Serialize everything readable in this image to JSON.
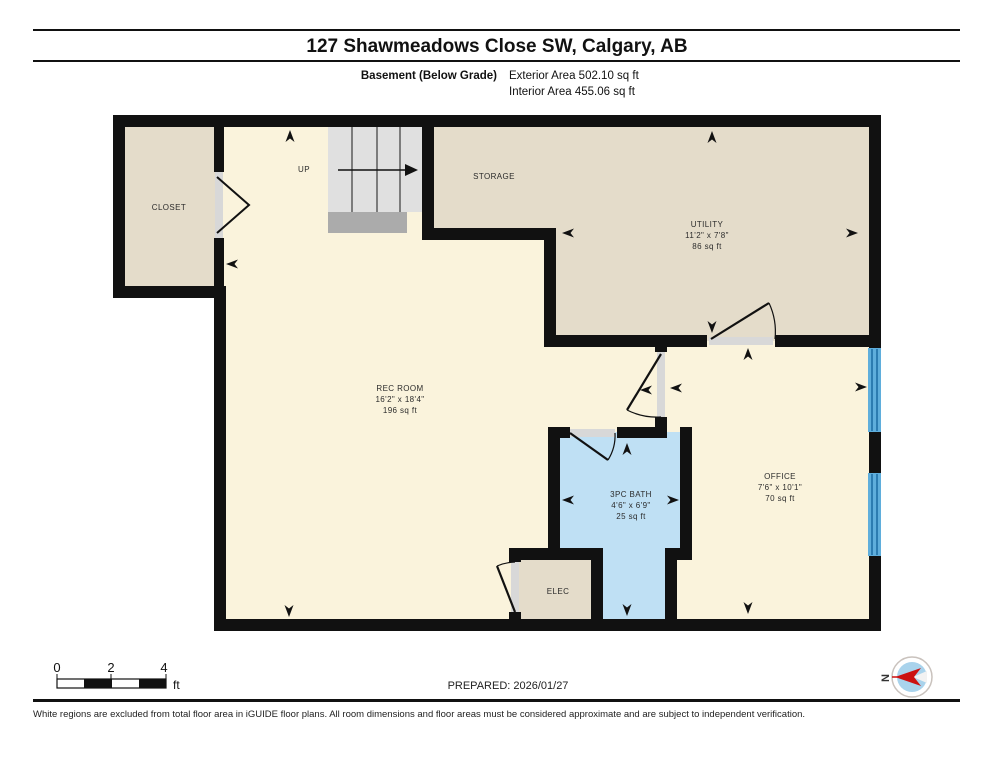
{
  "header": {
    "title": "127 Shawmeadows Close SW, Calgary, AB",
    "floor_label": "Basement (Below Grade)",
    "exterior_area": "Exterior Area 502.10 sq ft",
    "interior_area": "Interior Area 455.06 sq ft"
  },
  "rooms": {
    "closet": {
      "label": "CLOSET"
    },
    "stairs": {
      "label": "UP"
    },
    "storage": {
      "label": "STORAGE"
    },
    "utility": {
      "label": "UTILITY",
      "dimensions": "11'2\" x 7'8\"",
      "area": "86 sq ft"
    },
    "rec_room": {
      "label": "REC ROOM",
      "dimensions": "16'2\" x 18'4\"",
      "area": "196 sq ft"
    },
    "bath": {
      "label": "3PC BATH",
      "dimensions": "4'6\" x 6'9\"",
      "area": "25 sq ft"
    },
    "office": {
      "label": "OFFICE",
      "dimensions": "7'6\" x 10'1\"",
      "area": "70 sq ft"
    },
    "elec": {
      "label": "ELEC"
    }
  },
  "scale_bar": {
    "tick_0": "0",
    "tick_2": "2",
    "tick_4": "4",
    "unit": "ft"
  },
  "footer": {
    "prepared": "PREPARED: 2026/01/27",
    "compass_label": "N",
    "disclaimer": "White regions are excluded from total floor area in iGUIDE floor plans. All room dimensions and floor areas must be considered approximate and are subject to independent verification."
  },
  "colors": {
    "wall": "#111111",
    "cream_floor": "#faf3dc",
    "beige_floor": "#e4dcca",
    "bath_blue": "#bfe0f4",
    "stair_tread": "#e0e0e0",
    "stair_landing": "#ababab",
    "door_jamb": "#d8d8d8",
    "window_blue": "#5faedc",
    "compass_red": "#cc1111"
  }
}
